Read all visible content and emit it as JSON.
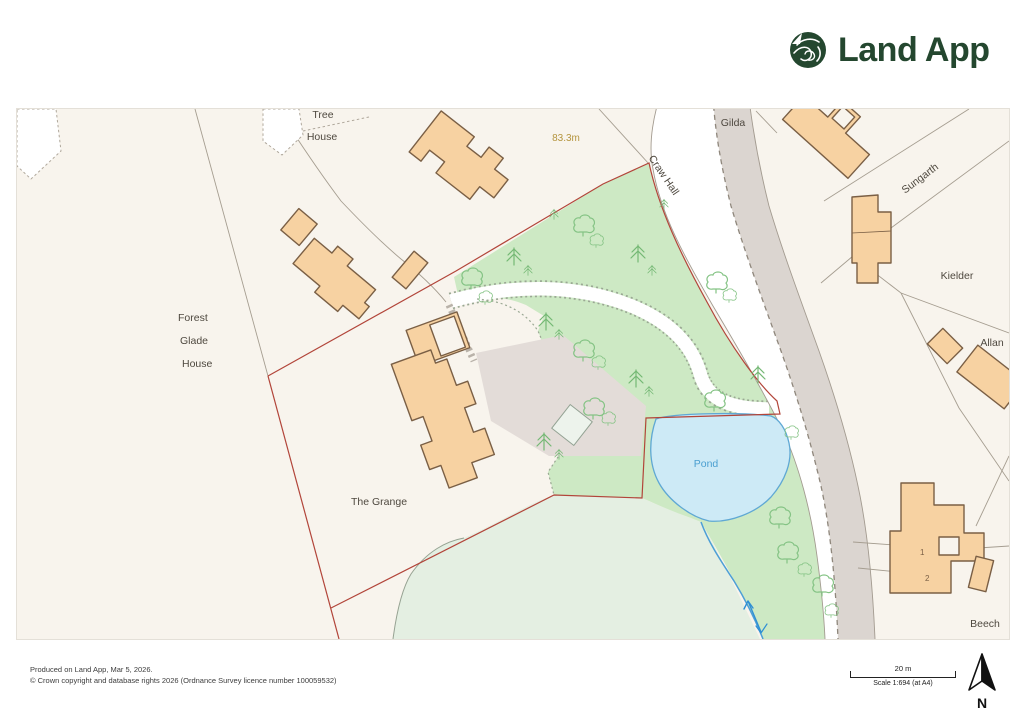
{
  "logo": {
    "app_name": "Land App"
  },
  "map": {
    "labels": {
      "tree_house_line1": "Tree",
      "tree_house_line2": "House",
      "spot_height": "83.3m",
      "road_name": "Craw Hall",
      "gilda": "Gilda",
      "sungarth": "Sungarth",
      "kielder": "Kielder",
      "allan": "Allan",
      "beech": "Beech",
      "forest_glade_line1": "Forest",
      "forest_glade_line2": "Glade",
      "forest_glade_line3": "House",
      "the_grange": "The Grange",
      "pond": "Pond",
      "building_1": "1",
      "building_2": "2"
    },
    "colors": {
      "background": "#f8f4ed",
      "boundary_red": "#b2453a",
      "woodland_green": "#cde9c4",
      "field_green": "#e4efe2",
      "pond_fill": "#cdeaf6",
      "pond_outline": "#5fa8d4",
      "building_fill": "#f7d2a2",
      "building_outline": "#7a5f45",
      "road_casing": "#a39b90",
      "verge_grey": "#dbd5d0",
      "logo_green": "#24472f"
    }
  },
  "footer": {
    "line1": "Produced on Land App, Mar 5, 2026.",
    "line2": "© Crown copyright and database rights 2026 (Ordnance Survey licence number 100059532)"
  },
  "scale_bar": {
    "distance_label": "20 m",
    "scale_label": "Scale 1:694 (at A4)"
  },
  "compass": {
    "north_label": "N"
  }
}
